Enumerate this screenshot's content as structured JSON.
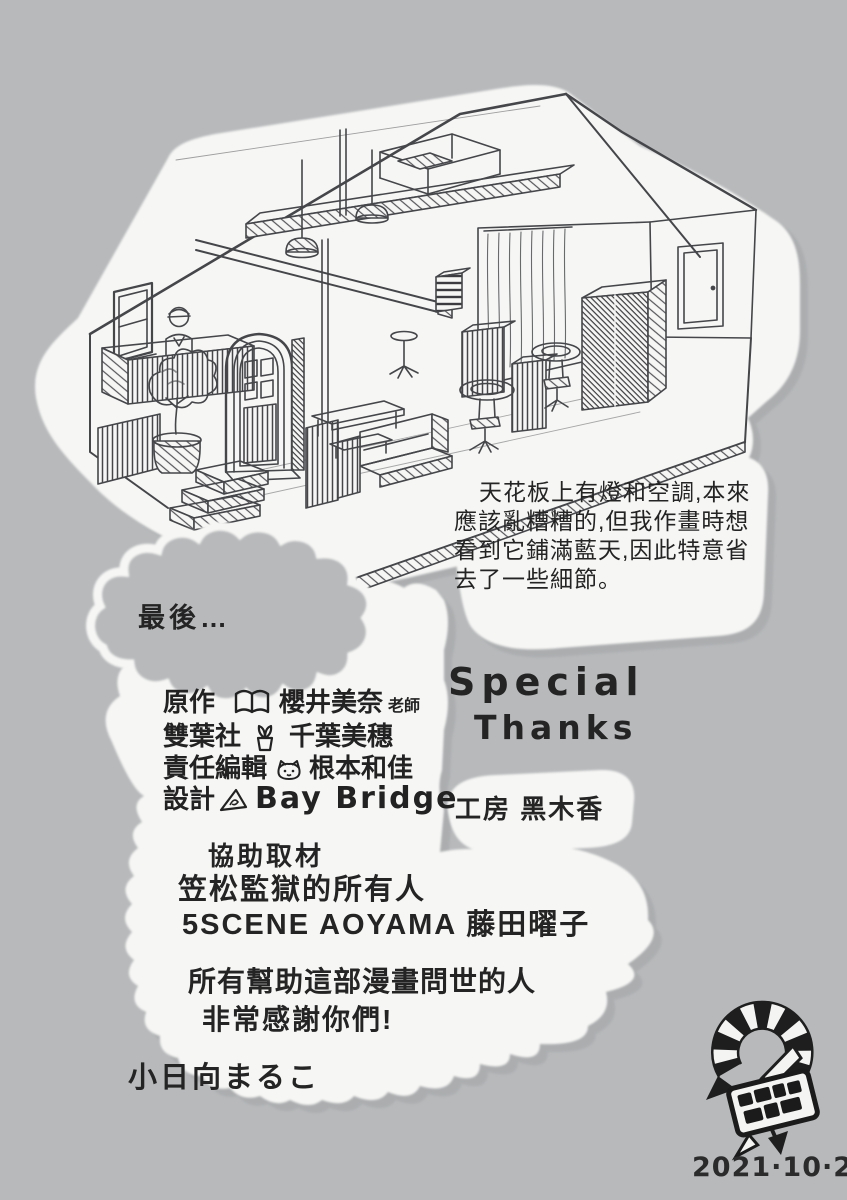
{
  "page": {
    "bg_color": "#b7b9bb",
    "paper_color": "#f6f6f4",
    "ink_color": "#242424"
  },
  "illustration": {
    "description": "pencil isometric cutaway sketch of a salon interior"
  },
  "note": {
    "lines": [
      "天花板上有燈和空調,本來",
      "應該亂糟糟的,但我作畫時想",
      "看到它鋪滿藍天,因此特意省",
      "去了一些細節。"
    ]
  },
  "cloud": {
    "label": "最後…"
  },
  "credits": {
    "rows": [
      {
        "role": "原作",
        "icon": "book-icon",
        "name": "櫻井美奈",
        "suffix": "老師"
      },
      {
        "role": "雙葉社",
        "icon": "sprout-icon",
        "name": "千葉美穗",
        "suffix": ""
      },
      {
        "role": "責任編輯",
        "icon": "cat-icon",
        "name": "根本和佳",
        "suffix": ""
      },
      {
        "role": "設計",
        "icon": "triangle-logo-icon",
        "name": "Bay Bridge",
        "suffix": ""
      }
    ],
    "studio": "工房 黑木香"
  },
  "special": {
    "line1": "Special",
    "line2": "Thanks"
  },
  "cooperation": {
    "title": "協助取材",
    "lines": [
      "笠松監獄的所有人",
      "5SCENE AOYAMA 藤田曜子"
    ]
  },
  "gratitude": {
    "lines": [
      "所有幫助這部漫畫問世的人",
      "非常感謝你們!"
    ]
  },
  "signature": "小日向まるこ",
  "footer": {
    "date": "2021·10·24"
  }
}
